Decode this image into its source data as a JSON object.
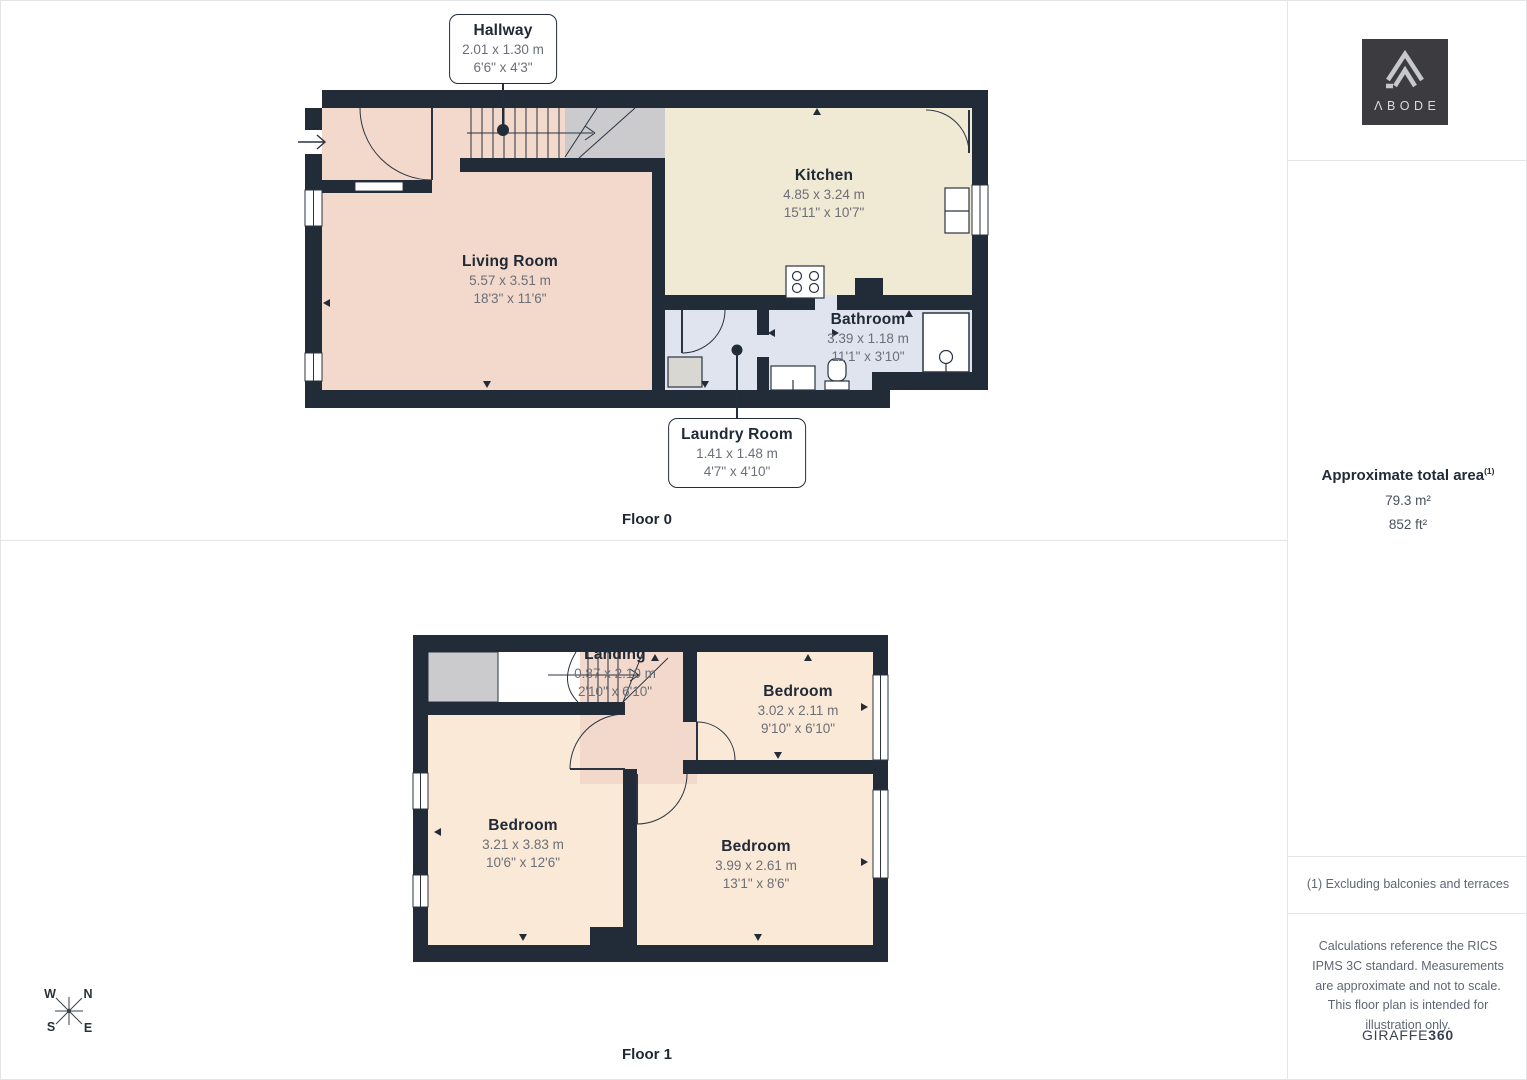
{
  "floor0": {
    "label": "Floor 0",
    "hallway": {
      "name": "Hallway",
      "metric": "2.01 x 1.30 m",
      "imperial": "6'6\" x 4'3\""
    },
    "living_room": {
      "name": "Living Room",
      "metric": "5.57 x 3.51 m",
      "imperial": "18'3\" x 11'6\""
    },
    "kitchen": {
      "name": "Kitchen",
      "metric": "4.85 x 3.24 m",
      "imperial": "15'11\" x 10'7\""
    },
    "bathroom": {
      "name": "Bathroom",
      "metric": "3.39 x 1.18 m",
      "imperial": "11'1\" x 3'10\""
    },
    "laundry_room": {
      "name": "Laundry Room",
      "metric": "1.41 x 1.48 m",
      "imperial": "4'7\" x 4'10\""
    }
  },
  "floor1": {
    "label": "Floor 1",
    "landing": {
      "name": "Landing",
      "metric": "0.87 x 2.10 m",
      "imperial": "2'10\" x 6'10\""
    },
    "bedroom_top_right": {
      "name": "Bedroom",
      "metric": "3.02 x 2.11 m",
      "imperial": "9'10\" x 6'10\""
    },
    "bedroom_left": {
      "name": "Bedroom",
      "metric": "3.21 x 3.83 m",
      "imperial": "10'6\" x 12'6\""
    },
    "bedroom_bottom_right": {
      "name": "Bedroom",
      "metric": "3.99 x 2.61 m",
      "imperial": "13'1\" x 8'6\""
    }
  },
  "compass": {
    "north": "N",
    "east": "E",
    "south": "S",
    "west": "W"
  },
  "sidebar": {
    "brand": "ΛBODE",
    "area": {
      "title": "Approximate total area",
      "footnote_marker": "(1)",
      "metric": "79.3 m²",
      "imperial": "852 ft²"
    },
    "footnote": "(1) Excluding balconies and terraces",
    "disclaimer": "Calculations reference the RICS IPMS 3C standard. Measurements are approximate and not to scale. This floor plan is intended for illustration only.",
    "credit": {
      "brand": "GIRAFFE",
      "suffix": "360"
    }
  },
  "colors": {
    "wall": "#222b38",
    "living": "#f2d9cb",
    "kitchen": "#f0e9d4",
    "bathroom": "#e0e4ee",
    "bedroom": "#fbe9d7",
    "gray_area": "#cbcbcd"
  }
}
